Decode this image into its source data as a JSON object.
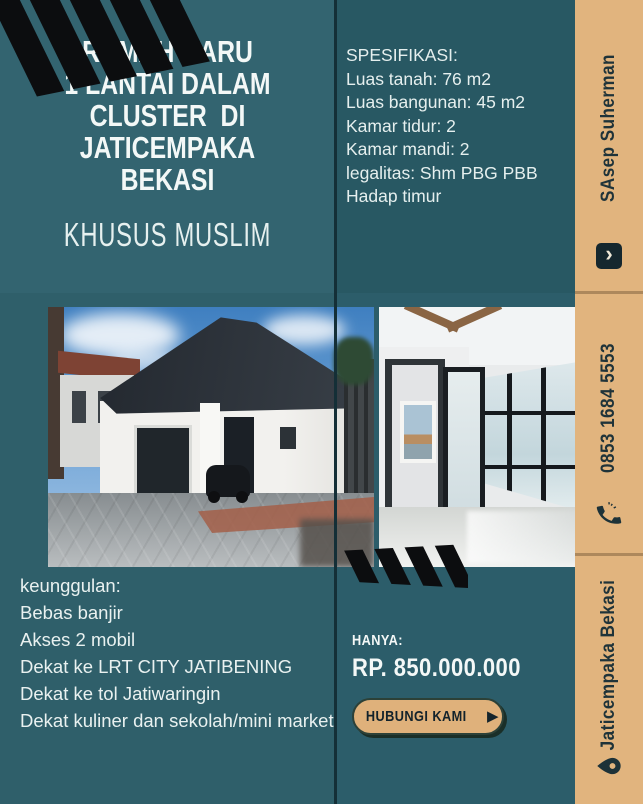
{
  "colors": {
    "teal_background": "#2f5f6a",
    "teal_spec_panel": "#285863",
    "sidebar_tan": "#e1b47e",
    "stripe_black": "#0c0d0f",
    "text_white": "#f3f8f7",
    "text_dark": "#1f3339",
    "cta_fill": "#dfb17b"
  },
  "title": {
    "lines": [
      "RUMAH BARU",
      "1 LANTAI DALAM",
      "CLUSTER  DI",
      "JATICEMPAKA",
      "BEKASI"
    ],
    "subtitle": "KHUSUS MUSLIM"
  },
  "specs": {
    "heading": "SPESIFIKASI:",
    "items": [
      "Luas tanah: 76 m2",
      "Luas bangunan: 45 m2",
      "Kamar tidur: 2",
      "Kamar mandi: 2",
      "legalitas: Shm PBG PBB",
      "Hadap timur"
    ]
  },
  "sidebar": {
    "agent": {
      "label": "SAsep Suherman",
      "icon": "contact-chevron-badge-icon",
      "glyph": "›"
    },
    "phone": {
      "label": "0853 1684 5553",
      "icon": "phone-icon"
    },
    "location": {
      "label": "Jaticempaka Bekasi",
      "icon": "location-pin-icon"
    }
  },
  "advantages": {
    "heading": "keunggulan:",
    "items": [
      "Bebas banjir",
      "Akses 2 mobil",
      "Dekat ke LRT CITY JATIBENING",
      "Dekat ke tol Jatiwaringin",
      "Dekat kuliner dan sekolah/mini market"
    ]
  },
  "offer": {
    "label": "HANYA:",
    "price": "RP. 850.000.000",
    "cta": "HUBUNGI KAMI",
    "arrow_glyph": "▶"
  }
}
